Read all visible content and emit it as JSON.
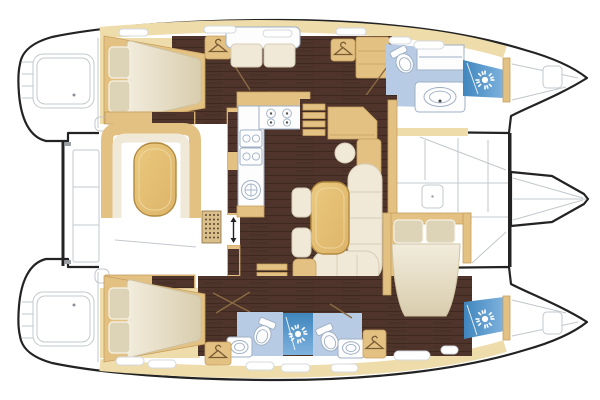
{
  "diagram": {
    "type": "catamaran-yacht-floor-plan",
    "orientation": "bow-right",
    "background": "#ffffff",
    "hulls": [
      "port-hull-top",
      "starboard-hull-bottom"
    ]
  },
  "colors": {
    "outline": "#232323",
    "thin-line": "#c3c8cd",
    "wood-floor": "#4e342b",
    "wood-stripe": "#3e2920",
    "deck-tan": "#eedcab",
    "furniture-tan": "#e2c183",
    "tan-border": "#c8a05f",
    "table-wood": "#eac97e",
    "table-border": "#b08a3e",
    "cushion-cream": "#f0e9d8",
    "cushion-border": "#d6cdb6",
    "mattress-light": "#f2ecdc",
    "mattress-shade": "#d9cdae",
    "pillow": "#ddd3b6",
    "bath-floor": "#b7cce4",
    "shower-deep": "#3f86bd",
    "shower-light": "#7fb2de",
    "fixture-white": "#fdfdfe",
    "fixture-line": "#9fb0c4",
    "door-line": "#8a6b42",
    "hanger": "#7a5c33",
    "grate-fill": "#d9c08b",
    "grate-dot": "#5d4433"
  },
  "rooms": {
    "port_hull": [
      "port-aft-cabin-double-berth",
      "port-corridor-lounge-sofa",
      "port-forward-bathroom",
      "port-bow-shower"
    ],
    "starboard_hull": [
      "starboard-aft-cabin-double-berth",
      "starboard-aft-head",
      "starboard-mid-shower",
      "starboard-forward-head",
      "starboard-forward-cabin-double-berth",
      "starboard-bow-shower"
    ],
    "bridgedeck": [
      "salon",
      "galley-with-stove-and-sink",
      "nav-station",
      "dining-table-with-settee",
      "aft-cockpit-with-table",
      "foredeck-trampoline",
      "bowsprit"
    ],
    "exterior": [
      "port-swim-platform",
      "starboard-swim-platform",
      "aft-crossbeam",
      "forward-crossbeam"
    ]
  },
  "icons": {
    "shower_sun_icons": 4,
    "clothes_hanger_icons": 4,
    "toilets": 3,
    "sinks": 3,
    "stove_burners": 4,
    "companionway_stairs": 2,
    "deck_hatches": 3
  }
}
